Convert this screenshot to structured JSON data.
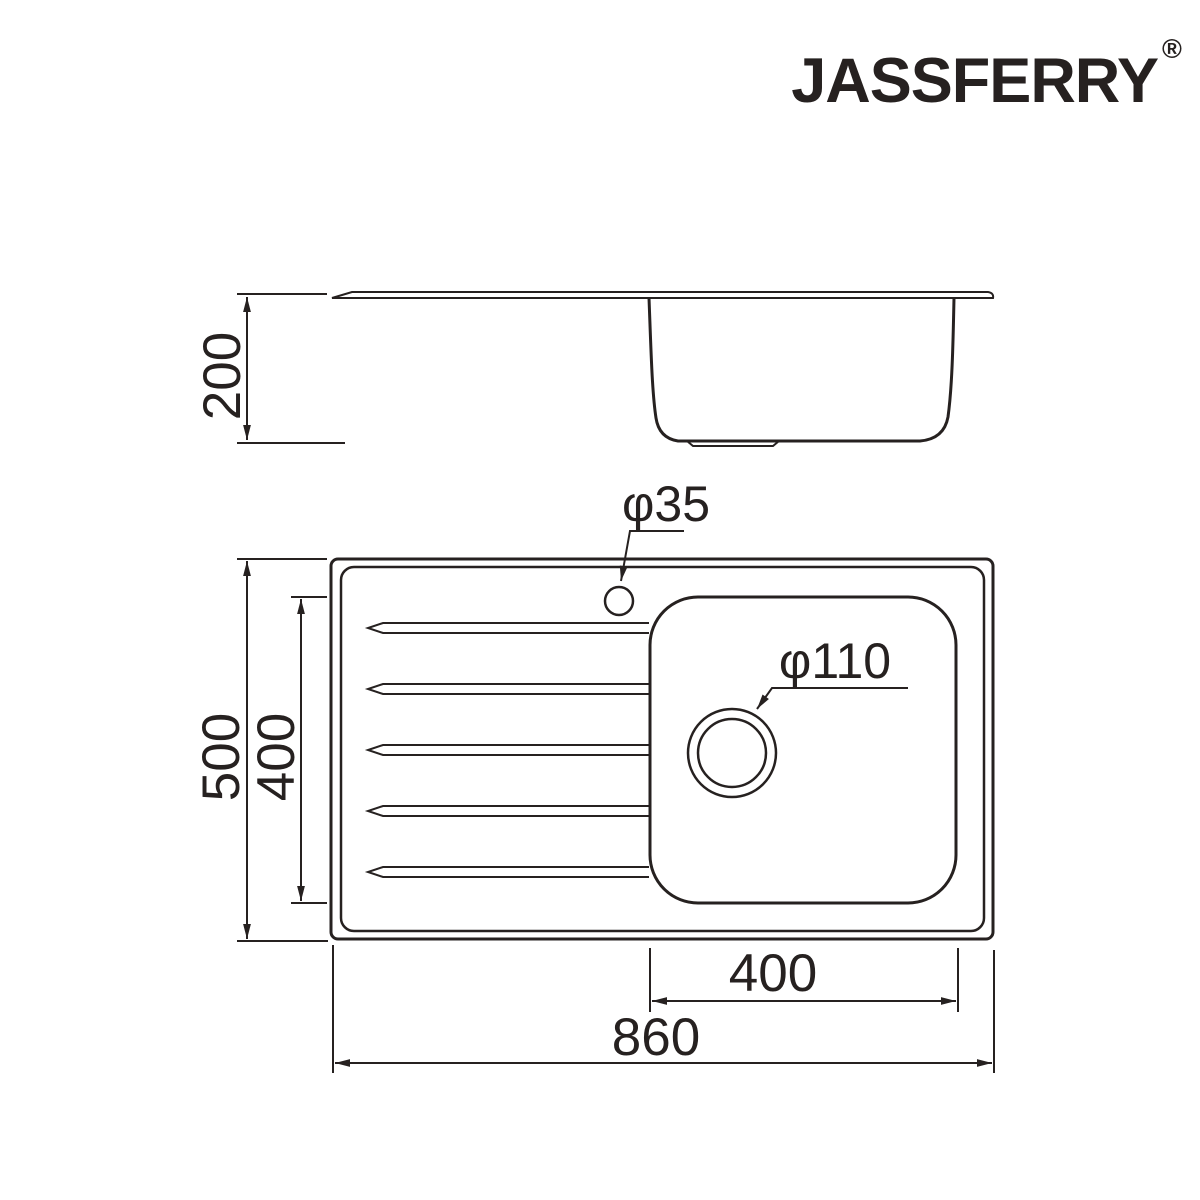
{
  "brand": {
    "name": "JASSFERRY",
    "registered_mark": "®"
  },
  "drawing": {
    "kind": "technical-dimension-drawing",
    "subject": "inset single-bowl kitchen sink with drainer",
    "views": [
      "side-elevation",
      "top-plan"
    ],
    "drainer_groove_count": 5
  },
  "dimensions": {
    "bowl_depth_mm": "200",
    "overall_length_mm": "860",
    "overall_width_mm": "500",
    "bowl_length_mm": "400",
    "bowl_width_mm": "400",
    "tap_hole_diameter": "φ35",
    "waste_hole_diameter": "φ110"
  },
  "style": {
    "line_color": "#262120",
    "background_color": "#ffffff"
  }
}
